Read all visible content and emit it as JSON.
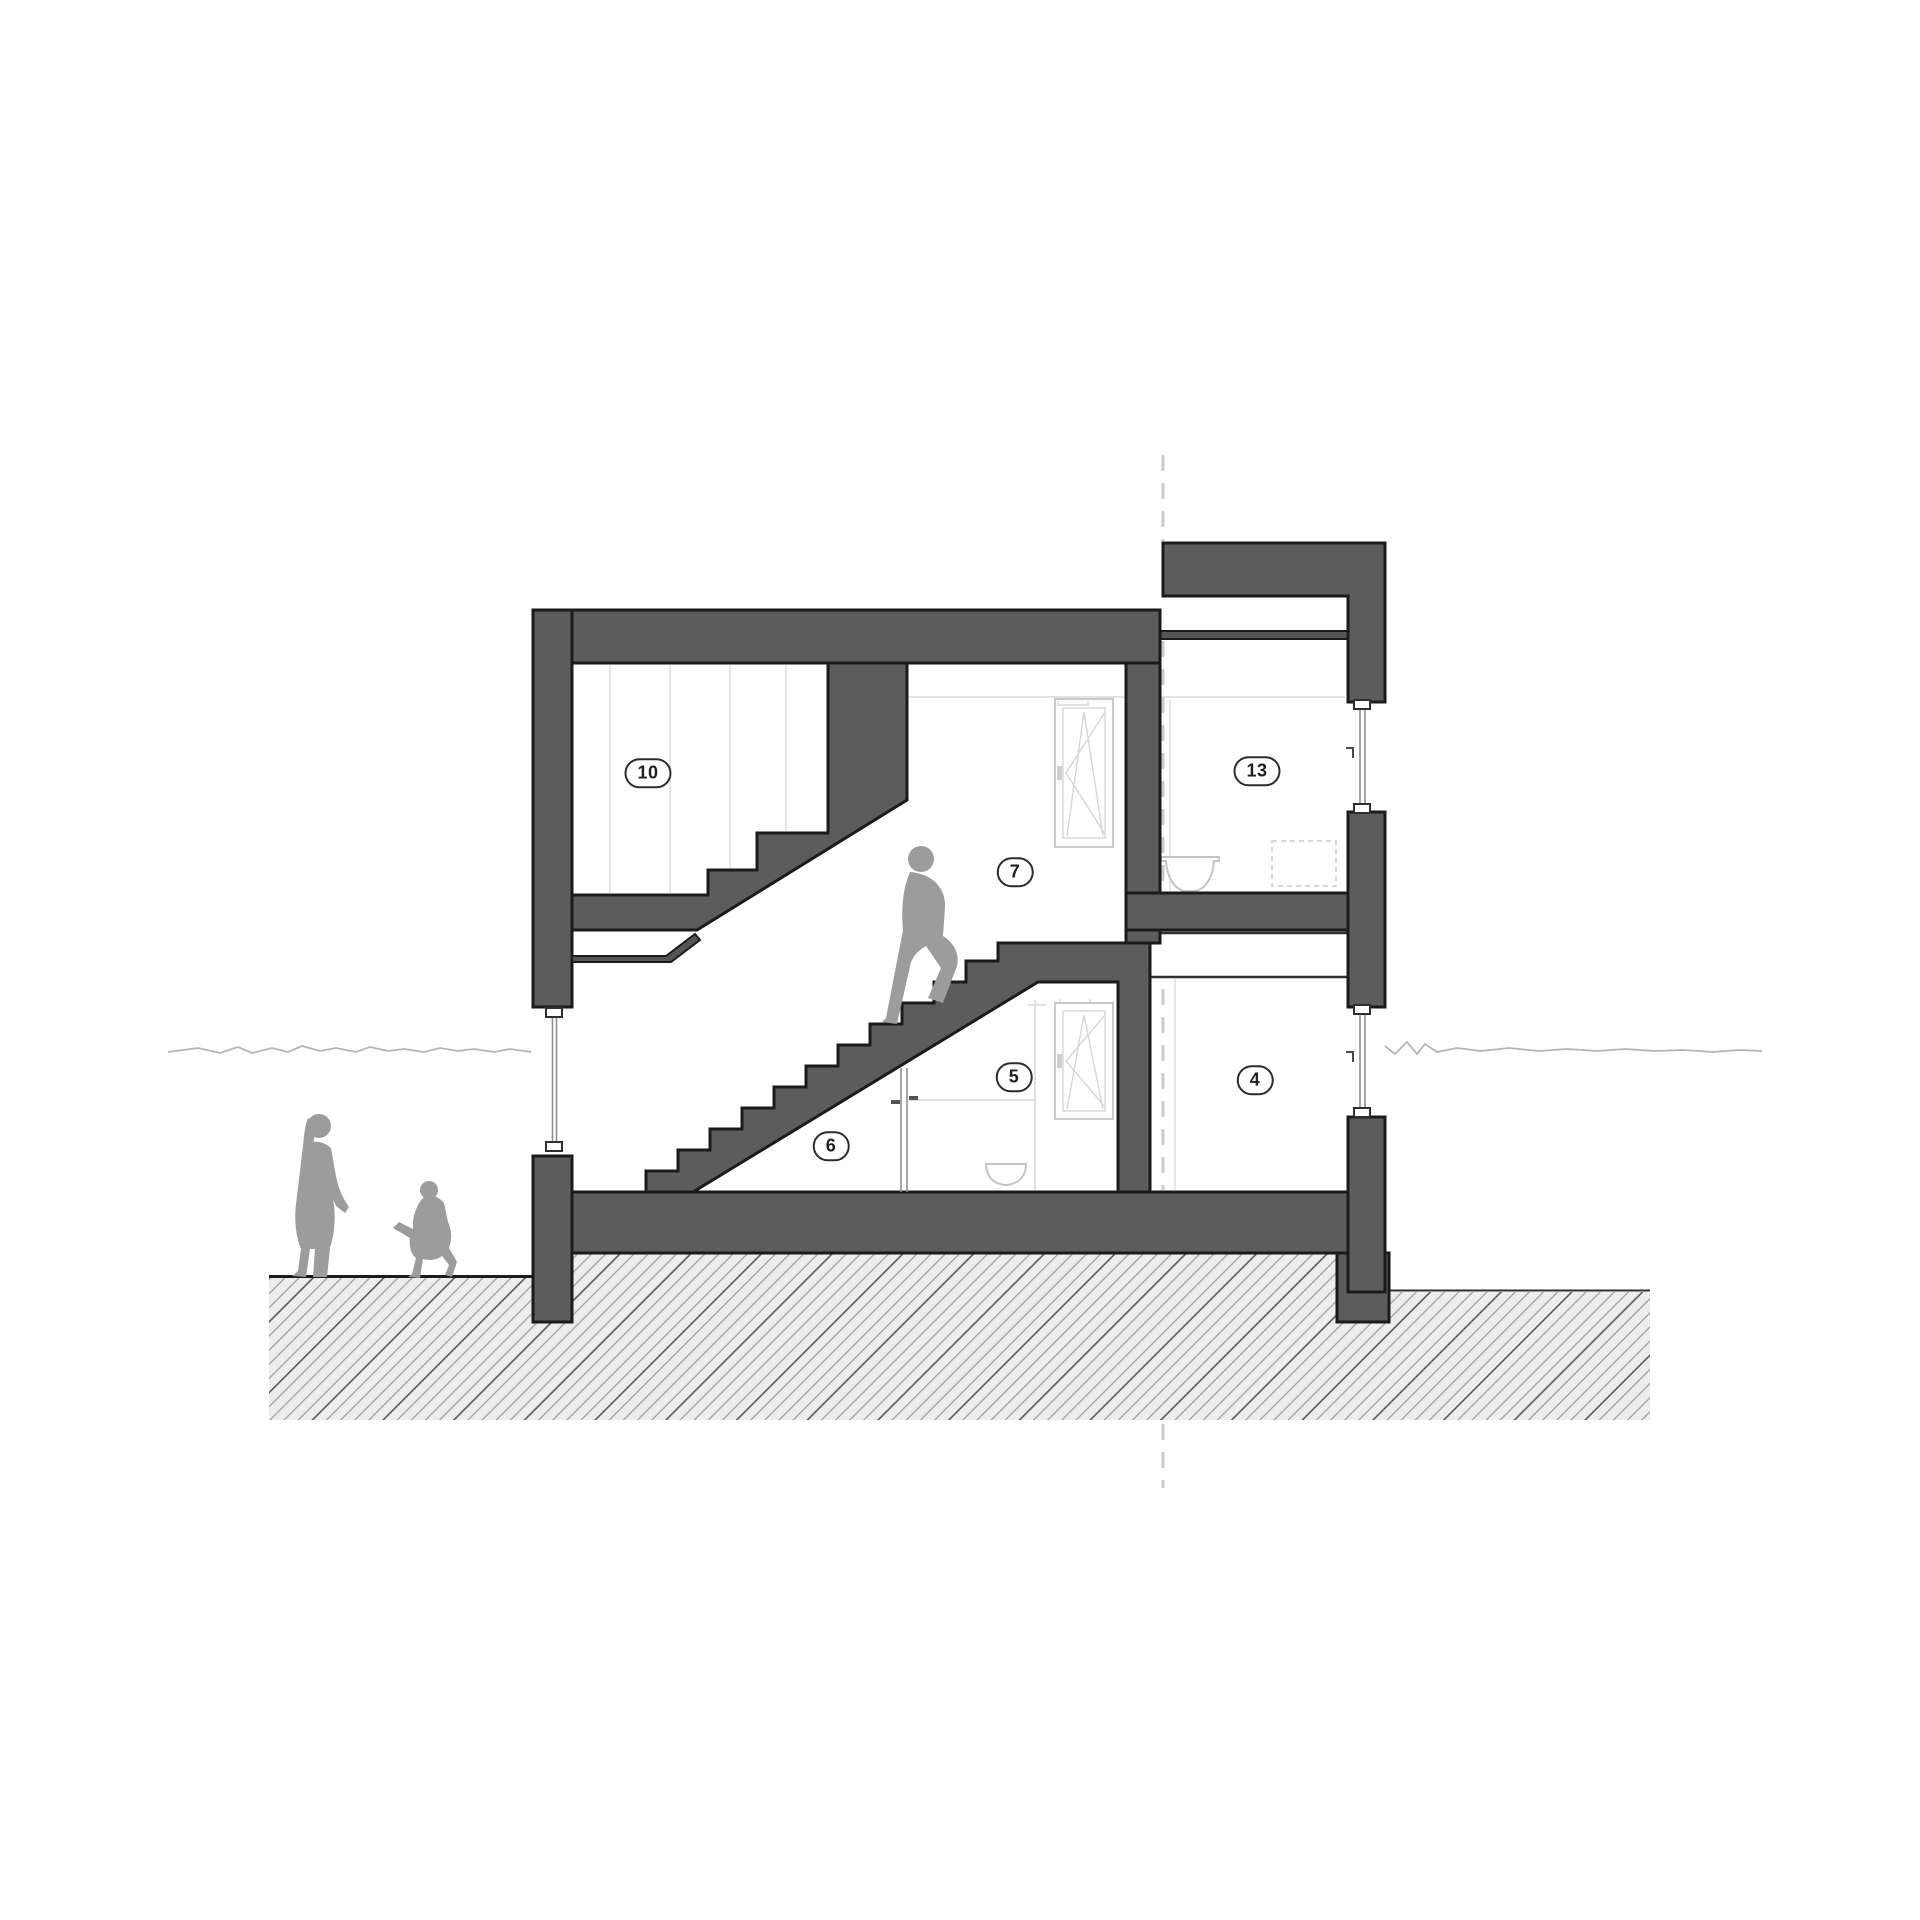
{
  "title": "Residential building cross-section drawing",
  "rooms": [
    {
      "number": "10"
    },
    {
      "number": "7"
    },
    {
      "number": "13"
    },
    {
      "number": "5"
    },
    {
      "number": "4"
    },
    {
      "number": "6"
    }
  ],
  "figures": {
    "adult": "woman silhouette",
    "child": "child silhouette",
    "stair_person": "man climbing stairs silhouette"
  },
  "colors": {
    "wall_fill": "#5c5c5c",
    "outline": "#1b1b1b",
    "figure_gray": "#9c9c9c",
    "hatch_background": "#ededed",
    "hatch_line": "#9a9a9a",
    "hatch_line_dark": "#4f4f4f",
    "badge_border": "#2b2b2b",
    "badge_text": "#1f1f1f",
    "faint_line": "#dedede",
    "dashed_reference_line": "#cbcbcb",
    "window_frame": "#c9c9c9",
    "ground_squiggle": "#b5b5b5"
  }
}
